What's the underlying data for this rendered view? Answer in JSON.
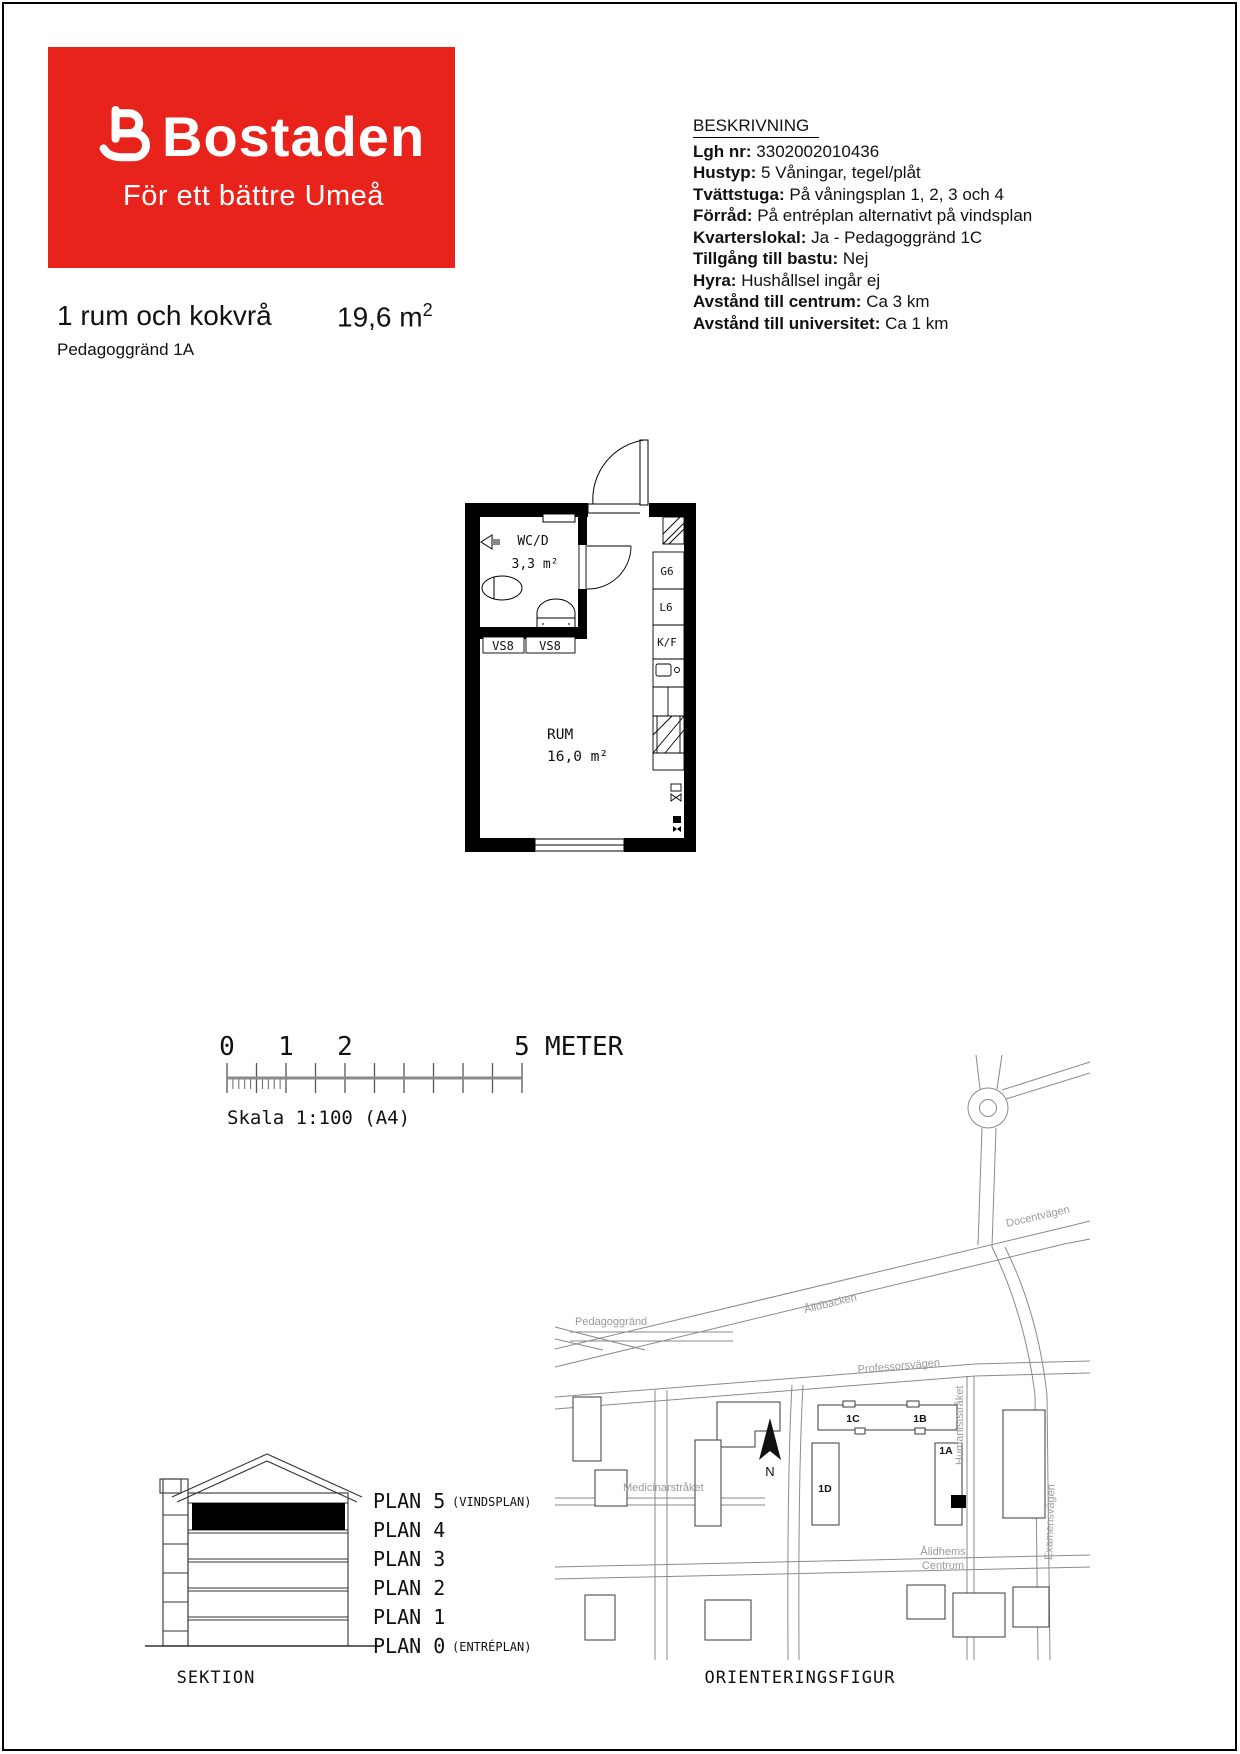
{
  "logo": {
    "brand": "Bostaden",
    "tagline": "För ett bättre Umeå",
    "bg_color": "#e7231b",
    "text_color": "#ffffff"
  },
  "header": {
    "title": "1 rum och kokvrå",
    "area": "19,6 m",
    "area_sup": "2",
    "address": "Pedagoggränd 1A"
  },
  "beskrivning": {
    "heading": "BESKRIVNING",
    "rows": [
      {
        "label": "Lgh nr:",
        "value": "3302002010436"
      },
      {
        "label": "Hustyp:",
        "value": "5 Våningar, tegel/plåt"
      },
      {
        "label": "Tvättstuga:",
        "value": "På våningsplan 1, 2, 3 och 4"
      },
      {
        "label": "Förråd:",
        "value": "På entréplan alternativt på vindsplan"
      },
      {
        "label": "Kvarterslokal:",
        "value": "Ja - Pedagoggränd 1C"
      },
      {
        "label": "Tillgång till bastu:",
        "value": "Nej"
      },
      {
        "label": "Hyra:",
        "value": "Hushållsel ingår ej"
      },
      {
        "label": "Avstånd till centrum:",
        "value": "Ca 3 km"
      },
      {
        "label": "Avstånd till universitet:",
        "value": "Ca 1 km"
      }
    ]
  },
  "floorplan": {
    "wc_name": "WC/D",
    "wc_area": "3,3 m²",
    "room_name": "RUM",
    "room_area": "16,0 m²",
    "vs_labels": [
      "VS8",
      "VS8"
    ],
    "kitchen_labels": [
      "G6",
      "L6",
      "K/F"
    ]
  },
  "scalebar": {
    "tick_0": "0",
    "tick_1": "1",
    "tick_2": "2",
    "tick_5": "5",
    "unit": "METER",
    "caption": "Skala 1:100 (A4)"
  },
  "sektion": {
    "caption": "SEKTION",
    "plans": [
      {
        "name": "PLAN 5",
        "suffix": "(VINDSPLAN)"
      },
      {
        "name": "PLAN 4",
        "suffix": ""
      },
      {
        "name": "PLAN 3",
        "suffix": ""
      },
      {
        "name": "PLAN 2",
        "suffix": ""
      },
      {
        "name": "PLAN 1",
        "suffix": ""
      },
      {
        "name": "PLAN 0",
        "suffix": "(ENTRÉPLAN)"
      }
    ]
  },
  "map": {
    "caption": "ORIENTERINGSFIGUR",
    "compass": "N",
    "streets": {
      "alidbacken": "Ålidbacken",
      "professorsvagen": "Professorsvägen",
      "docentvagen": "Docentvägen",
      "pedagoggrand": "Pedagoggränd",
      "humaniststraket": "Humaniststråket",
      "examensvagen": "Examensvägen",
      "medicinarstraket": "Medicinarstråket"
    },
    "area_label": {
      "line1": "Ålidhems",
      "line2": "Centrum"
    },
    "buildings": {
      "b1c": "1C",
      "b1b": "1B",
      "b1d": "1D",
      "b1a": "1A"
    }
  }
}
